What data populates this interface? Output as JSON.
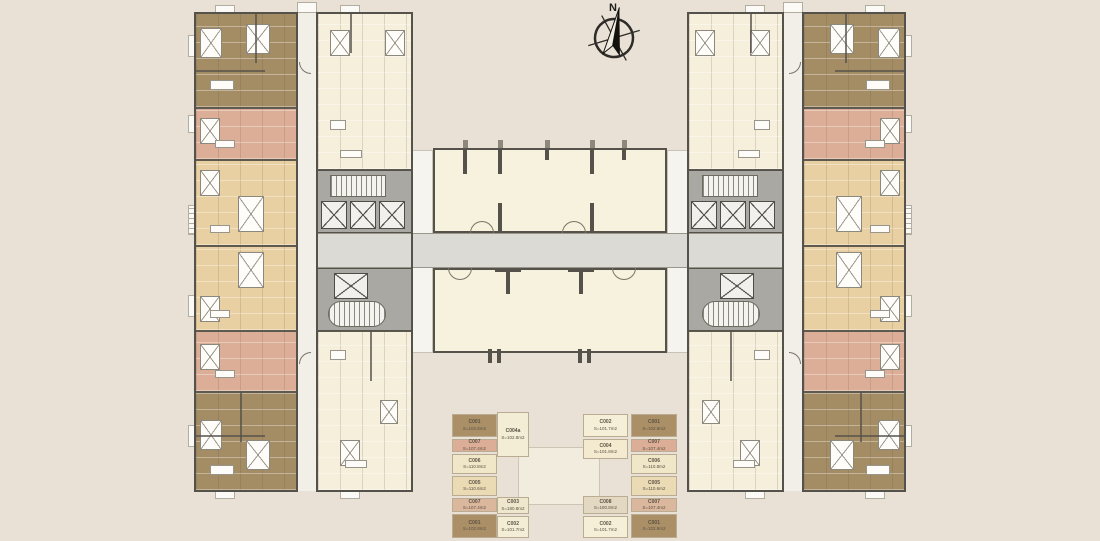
{
  "compass": {
    "label": "N"
  },
  "colors": {
    "background": "#e9e1d6",
    "cream_unit": "#f6efdb",
    "tan_unit": "#e9d0a2",
    "brown_unit": "#a48c64",
    "salmon_unit": "#dcae97",
    "hall": "#f7f2dd",
    "core": "#a9a8a3",
    "corridor_vertical": "#f2efe8",
    "corridor_horizontal": "#dcdad4",
    "faint_structure": "#f2ecdf"
  },
  "legend": {
    "columns": [
      {
        "name": "left-outer",
        "items": [
          {
            "code": "C001",
            "area": "S=102.8m2",
            "color": "#ab9067"
          },
          {
            "code": "C007",
            "area": "S=107.4m2",
            "color": "#dcae97"
          },
          {
            "code": "C006",
            "area": "S=110.8m2",
            "color": "#f0e6c8"
          },
          {
            "code": "C005",
            "area": "S=110.6m2",
            "color": "#eadbb5"
          },
          {
            "code": "C007",
            "area": "S=107.4m2",
            "color": "#dbb79e"
          },
          {
            "code": "C001",
            "area": "S=102.8m2",
            "color": "#ab9067"
          }
        ]
      },
      {
        "name": "left-middle",
        "items": [
          {
            "code": "C004a",
            "area": "S=102.8m2",
            "color": "#f4edd6"
          },
          {
            "code": "C003",
            "area": "S=180.8m2",
            "color": "#efe7cd"
          },
          {
            "code": "C002",
            "area": "S=101.7m2",
            "color": "#f4edd6"
          }
        ]
      },
      {
        "name": "right-middle",
        "items": [
          {
            "code": "C002",
            "area": "S=101.7m2",
            "color": "#f6efd8"
          },
          {
            "code": "C004",
            "area": "S=101.8m2",
            "color": "#f4ead0"
          },
          {
            "code": "C008",
            "area": "S=180.8m2",
            "color": "#e3d9c2"
          },
          {
            "code": "C002",
            "area": "S=101.7m2",
            "color": "#f6efd8"
          }
        ]
      },
      {
        "name": "right-outer",
        "items": [
          {
            "code": "C001",
            "area": "S=102.8m2",
            "color": "#ab9067"
          },
          {
            "code": "C007",
            "area": "S=107.4m2",
            "color": "#dcae97"
          },
          {
            "code": "C006",
            "area": "S=110.8m2",
            "color": "#f0e6c8"
          },
          {
            "code": "C005",
            "area": "S=110.6m2",
            "color": "#eadbb5"
          },
          {
            "code": "C007",
            "area": "S=107.4m2",
            "color": "#dbb79e"
          },
          {
            "code": "C001",
            "area": "S=102.8m2",
            "color": "#ab9067"
          }
        ]
      }
    ]
  }
}
